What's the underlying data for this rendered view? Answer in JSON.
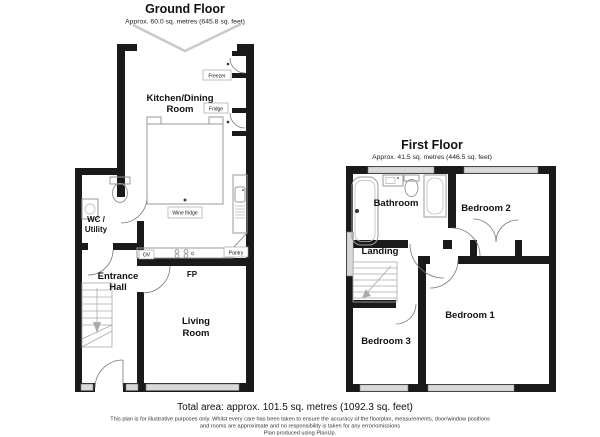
{
  "ground_floor": {
    "title": "Ground Floor",
    "subtitle": "Approx. 60.0 sq. metres (645.8 sq. feet)",
    "rooms": {
      "kitchen_line1": "Kitchen/Dining",
      "kitchen_line2": "Room",
      "wc_line1": "WC /",
      "wc_line2": "Utility",
      "entrance_line1": "Entrance",
      "entrance_line2": "Hall",
      "living_line1": "Living",
      "living_line2": "Room"
    },
    "fixtures": {
      "freezer": "Freezer",
      "fridge": "Fridge",
      "wine_fridge": "Wine fridge",
      "oven": "OV",
      "pantry": "Pantry",
      "fireplace": "FP"
    }
  },
  "first_floor": {
    "title": "First Floor",
    "subtitle": "Approx. 41.5 sq. metres (446.5 sq. feet)",
    "rooms": {
      "bathroom": "Bathroom",
      "bedroom2": "Bedroom 2",
      "landing": "Landing",
      "bedroom3": "Bedroom 3",
      "bedroom1": "Bedroom 1"
    }
  },
  "footer": {
    "total_area": "Total area: approx. 101.5 sq. metres (1092.3 sq. feet)",
    "disclaimer_line1": "This plan is for illustrative purposes only. Whilst every care has been taken to ensure the accuracy of the floorplan, measurements, door/window positions",
    "disclaimer_line2": "and rooms are approximate and no responsibility is taken for any error/omissions",
    "credit": "Plan produced using PlanUp."
  },
  "colors": {
    "wall": "#1a1a1a",
    "window_fill": "#d9d9d9",
    "fixture_outline": "#9a9a9a",
    "ceiling_line": "#c9c9c9"
  }
}
